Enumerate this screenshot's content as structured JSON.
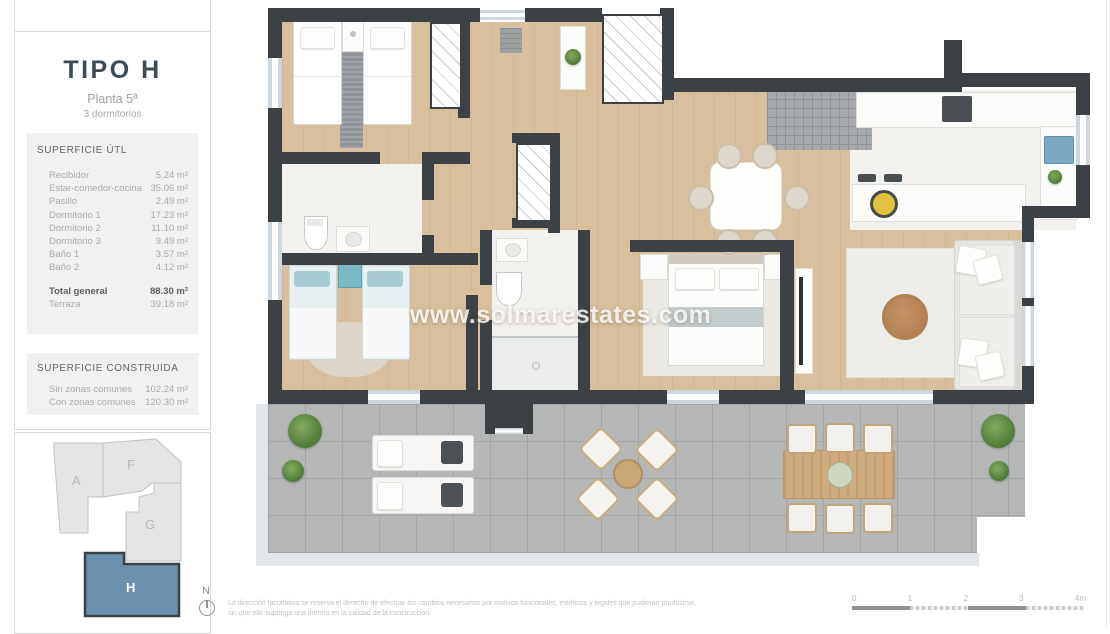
{
  "panel": {
    "type_title": "TIPO H",
    "floor": "Planta 5ª",
    "bedrooms": "3 dormitorios",
    "useful_area": {
      "heading": "SUPERFICIE ÚTL",
      "rows": [
        {
          "label": "Recibidor",
          "value": "5.24 m²"
        },
        {
          "label": "Estar-comedor-cocina",
          "value": "35.06 m²"
        },
        {
          "label": "Pasillo",
          "value": "2.49 m²"
        },
        {
          "label": "Dormitorio 1",
          "value": "17.23 m²"
        },
        {
          "label": "Dormitorio 2",
          "value": "11.10 m²"
        },
        {
          "label": "Dormitorio 3",
          "value": "9.49 m²"
        },
        {
          "label": "Baño 1",
          "value": "3.57 m²"
        },
        {
          "label": "Baño 2",
          "value": "4.12 m²"
        }
      ],
      "total": {
        "label": "Total general",
        "value": "88.30 m²"
      },
      "terrace": {
        "label": "Terraza",
        "value": "39.18 m²"
      }
    },
    "built_area": {
      "heading": "SUPERFICIE CONSTRUIDA",
      "rows": [
        {
          "label": "Sin zonas comunes",
          "value": "102.24 m²"
        },
        {
          "label": "Con zonas comunes",
          "value": "120.30 m²"
        }
      ]
    },
    "key_plan": {
      "units": [
        "A",
        "F",
        "G",
        "H"
      ],
      "highlighted": "H"
    },
    "compass_label": "N"
  },
  "plan": {
    "watermark": "www.solmarestates.com"
  },
  "footer": {
    "disclaimer_line1": "La dirección facultativa se reserva el derecho de efectuar los cambios necesarios por motivos funcionales, estéticos y legales que pudieran producirse,",
    "disclaimer_line2": "sin que ello suponga una merma en la calidad de la construcción.",
    "scale_labels": [
      "0",
      "1",
      "2",
      "3",
      "4m"
    ]
  },
  "colors": {
    "wall": "#3b4145",
    "wood_floor": "#d8c09f",
    "terrace_tile": "#b5b6b6",
    "unit_highlight": "#6b90ad",
    "title_text": "#3b4b57"
  }
}
